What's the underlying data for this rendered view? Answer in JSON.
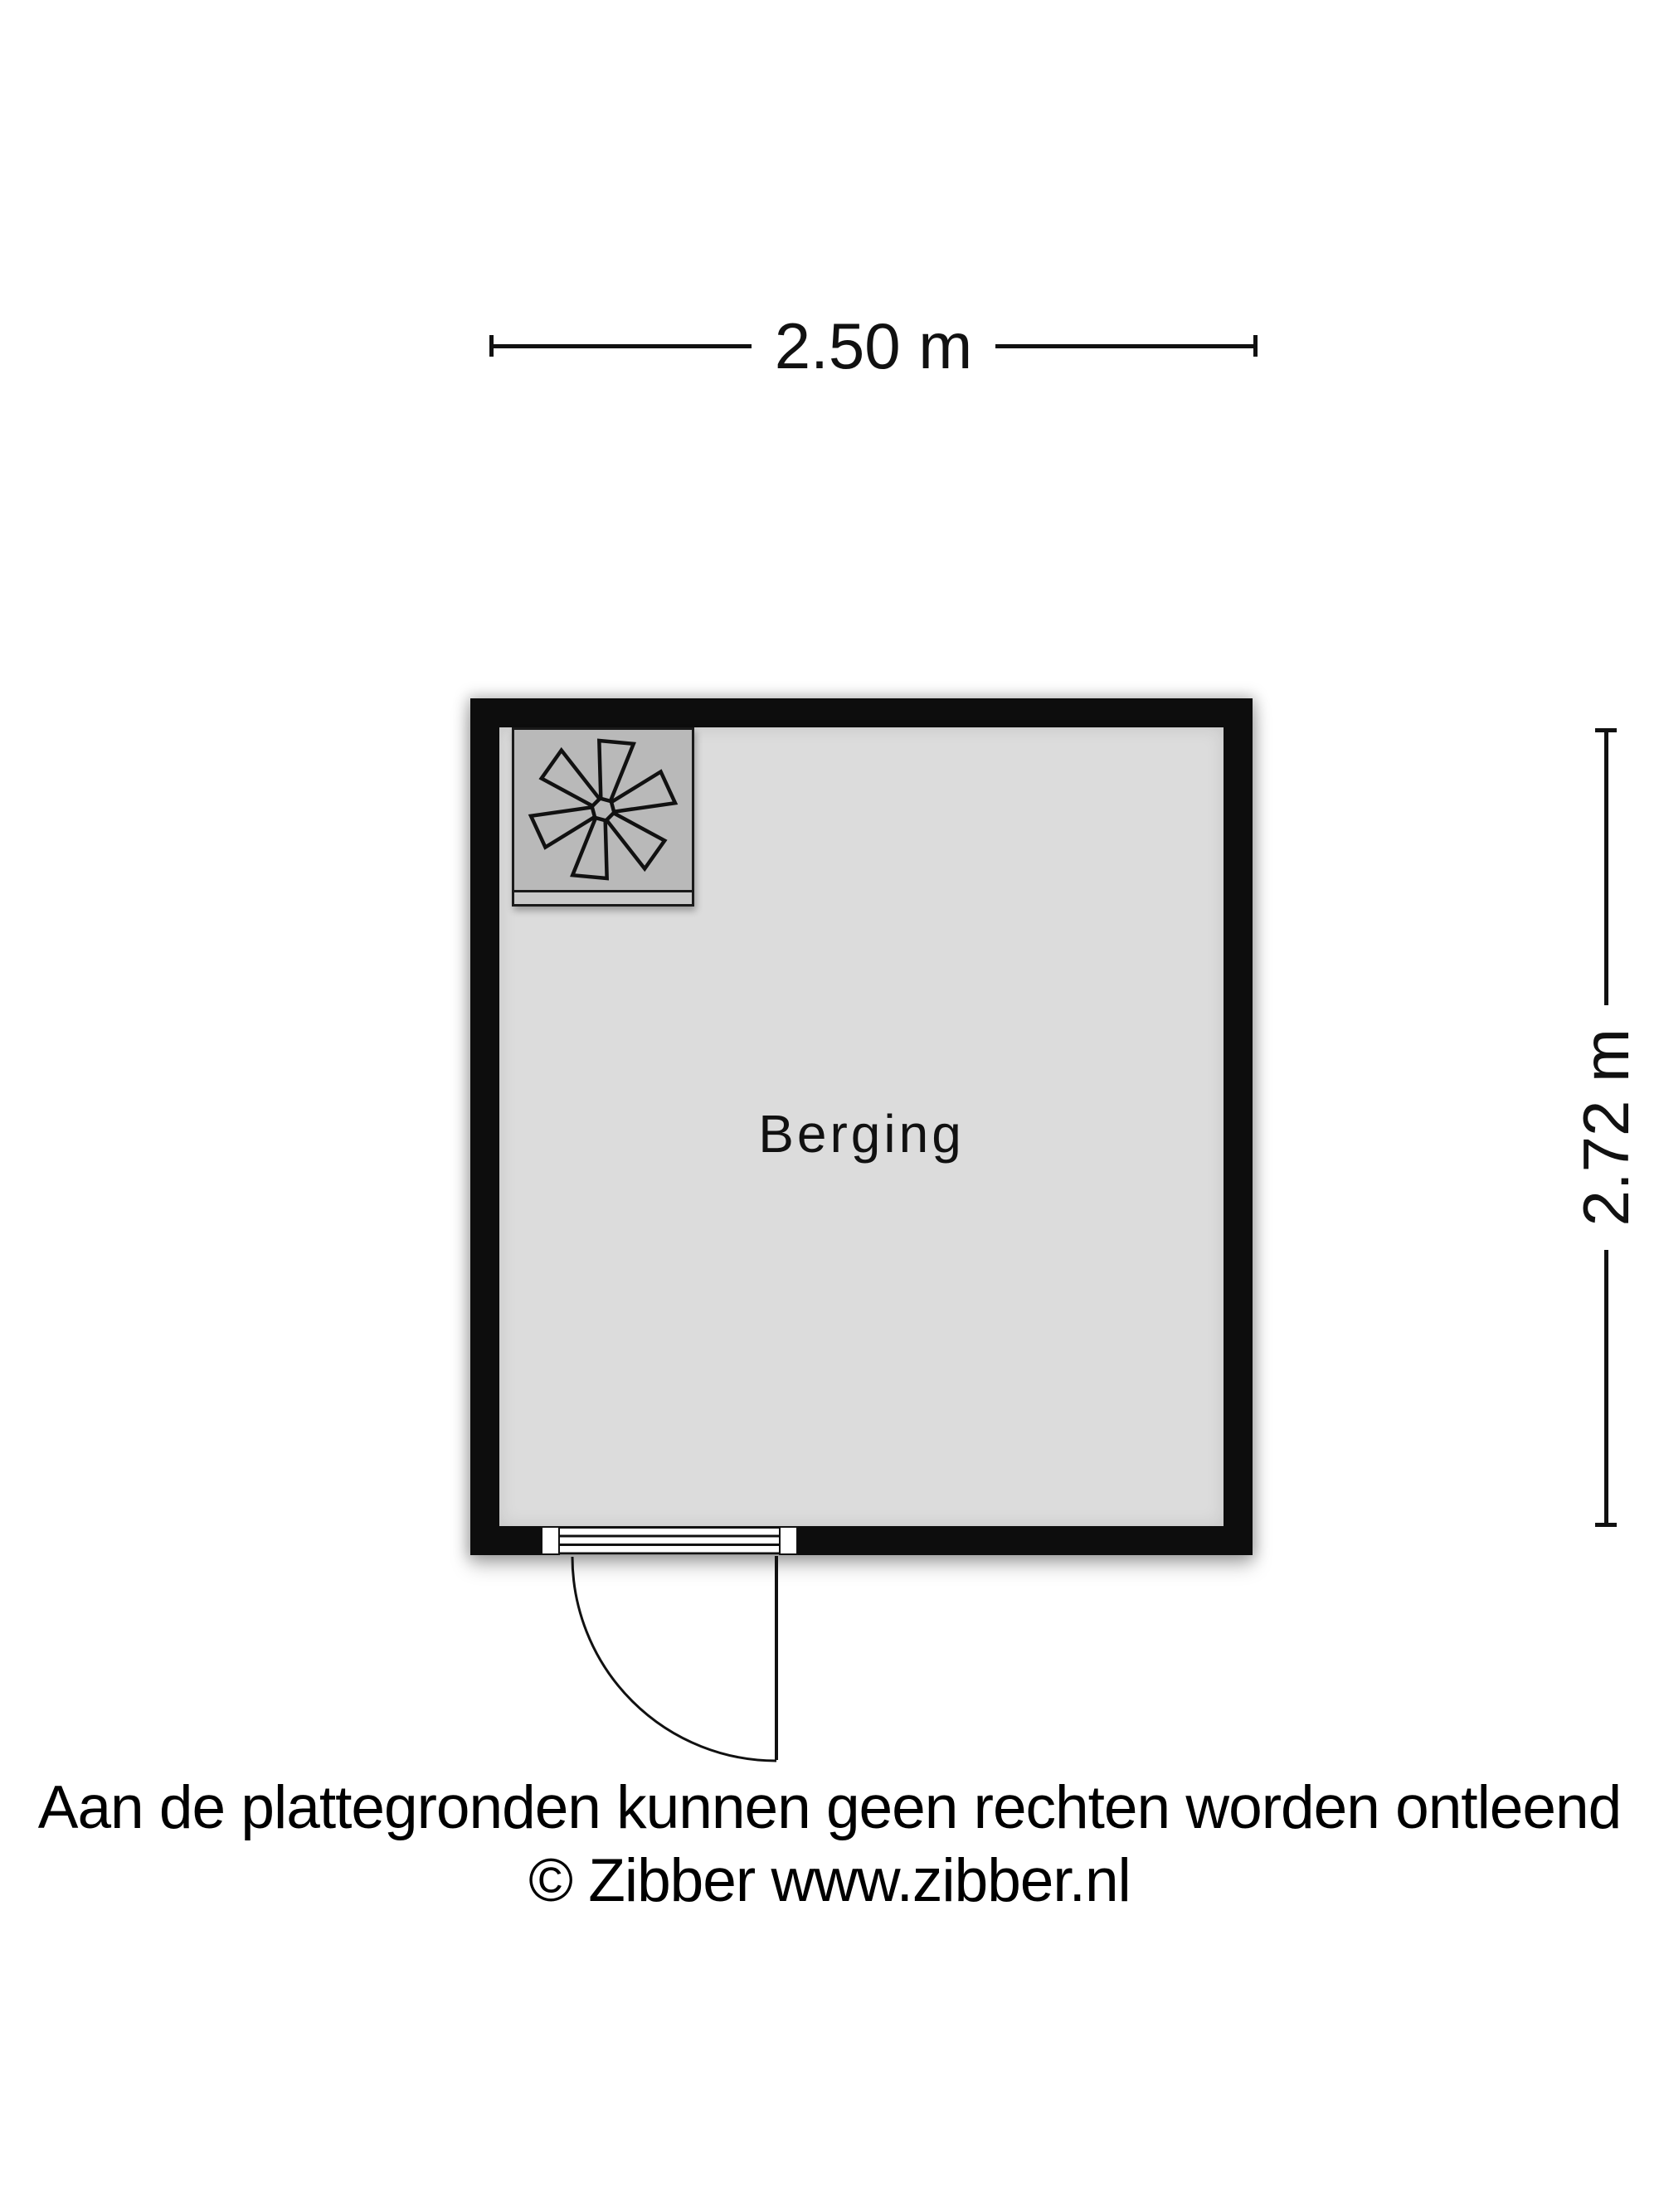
{
  "floorplan": {
    "room": {
      "label": "Berging"
    },
    "dimensions": {
      "width_label": "2.50 m",
      "height_label": "2.72 m"
    },
    "fan_unit": {
      "icon": "fan-icon"
    },
    "colors": {
      "wall": "#0d0d0d",
      "floor": "#dcdcdc",
      "appliance_box": "#b9b9b9",
      "text": "#111111"
    }
  },
  "footer": {
    "disclaimer": "Aan de plattegronden kunnen geen rechten worden ontleend",
    "credit": "© Zibber www.zibber.nl"
  }
}
